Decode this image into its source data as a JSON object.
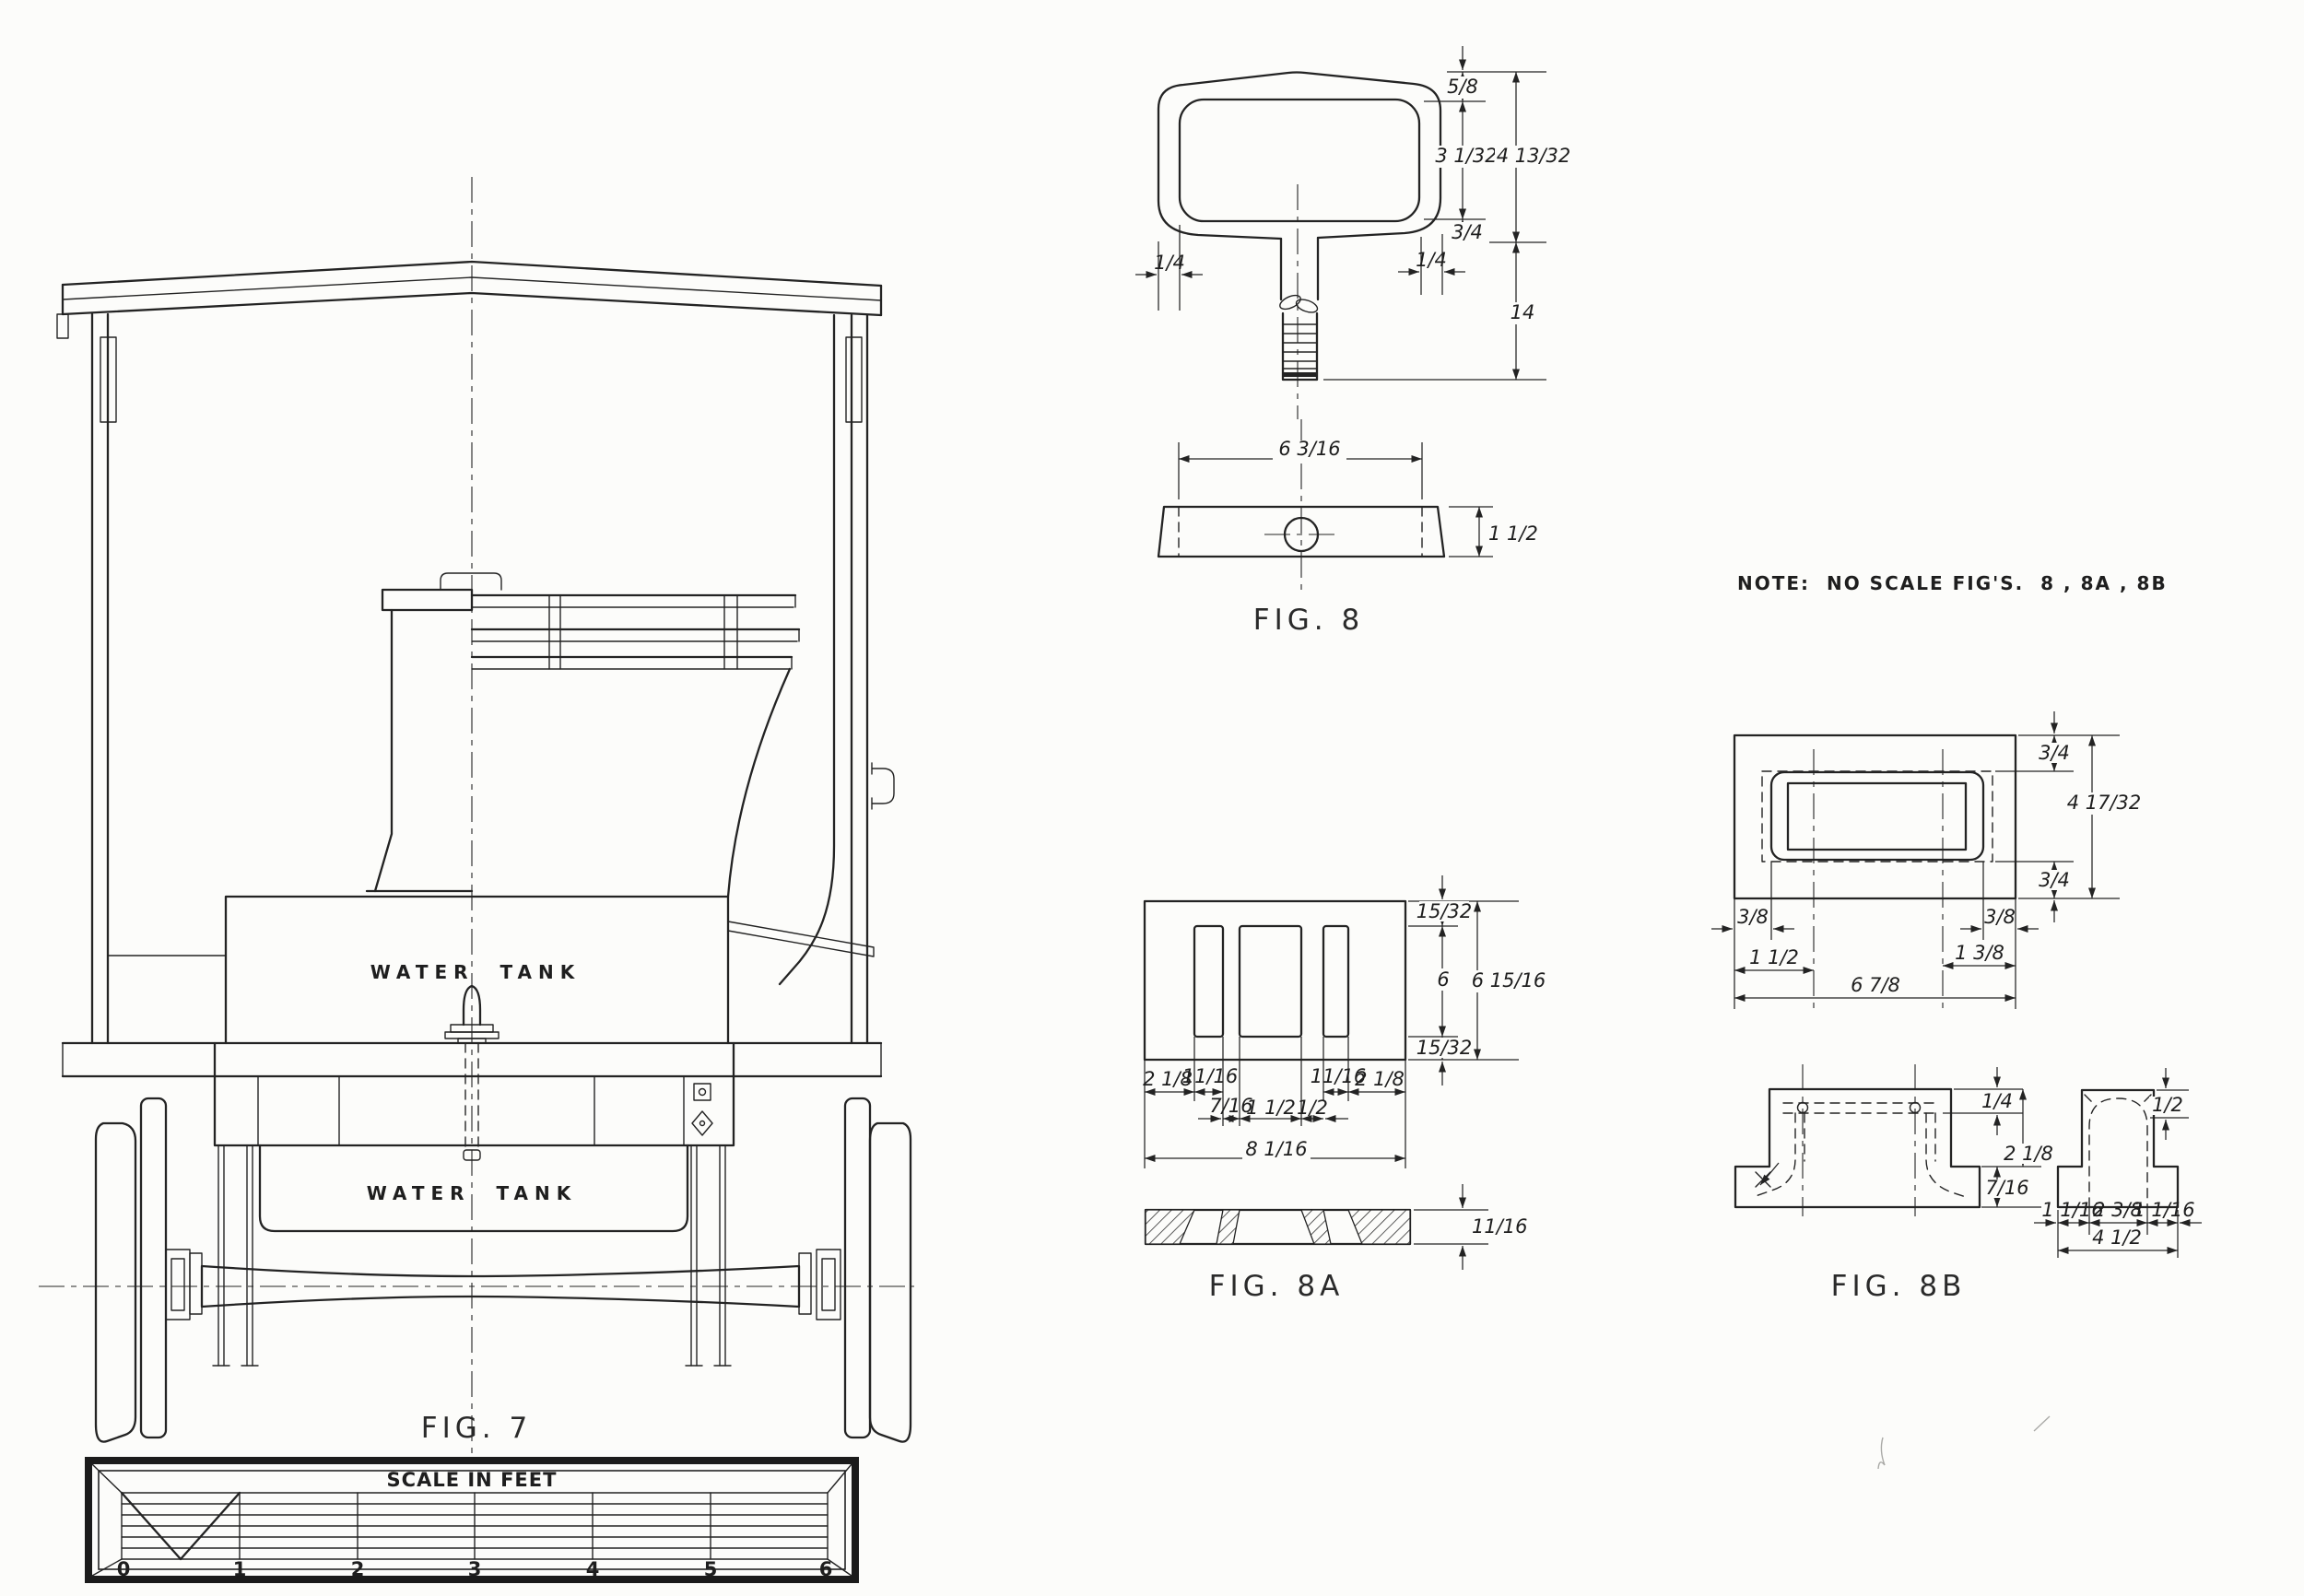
{
  "sheet": {
    "note": "NOTE:  NO SCALE FIG'S.  8 , 8A , 8B"
  },
  "fig7": {
    "label": "FIG. 7",
    "upper_tank_label": "WATER  TANK",
    "lower_tank_label": "WATER  TANK",
    "scale_bar": {
      "title": "SCALE IN FEET",
      "ticks": [
        "0",
        "1",
        "2",
        "3",
        "4",
        "5",
        "6"
      ]
    }
  },
  "fig8": {
    "label": "FIG. 8",
    "dims": {
      "grip_top_thickness": "5/8",
      "grip_opening_height": "3 1/32",
      "head_overall_height": "4 13/32",
      "grip_bottom_thickness": "3/4",
      "left_wall_thickness": "1/4",
      "right_wall_thickness": "1/4",
      "overall_length": "14",
      "plan_length": "6 3/16",
      "plan_depth": "1 1/2"
    }
  },
  "fig8a": {
    "label": "FIG. 8A",
    "dims": {
      "top_margin": "15/32",
      "slot_height": "6",
      "bottom_margin": "15/32",
      "overall_height": "6 15/16",
      "left_margin": "2 1/8",
      "left_slot_width": "11/16",
      "right_slot_width": "11/16",
      "right_margin": "2 1/8",
      "left_web": "7/16",
      "center_slot_width": "1 1/2",
      "right_web": "1/2",
      "overall_width": "8 1/16",
      "section_thickness": "11/16"
    }
  },
  "fig8b": {
    "label": "FIG. 8B",
    "dims": {
      "top_margin": "3/4",
      "overall_height": "4 17/32",
      "bottom_margin": "3/4",
      "left_edge_margin": "3/8",
      "right_edge_margin": "3/8",
      "left_hole_offset": "1 1/2",
      "right_hole_offset": "1 3/8",
      "overall_width": "6 7/8",
      "plate_thickness": "1/4",
      "body_height": "2 1/8",
      "base_height": "7/16",
      "lip_depth": "1/2",
      "base_left": "1 1/16",
      "base_center": "2 3/8",
      "base_right": "1 1/16",
      "base_overall": "4 1/2"
    }
  }
}
